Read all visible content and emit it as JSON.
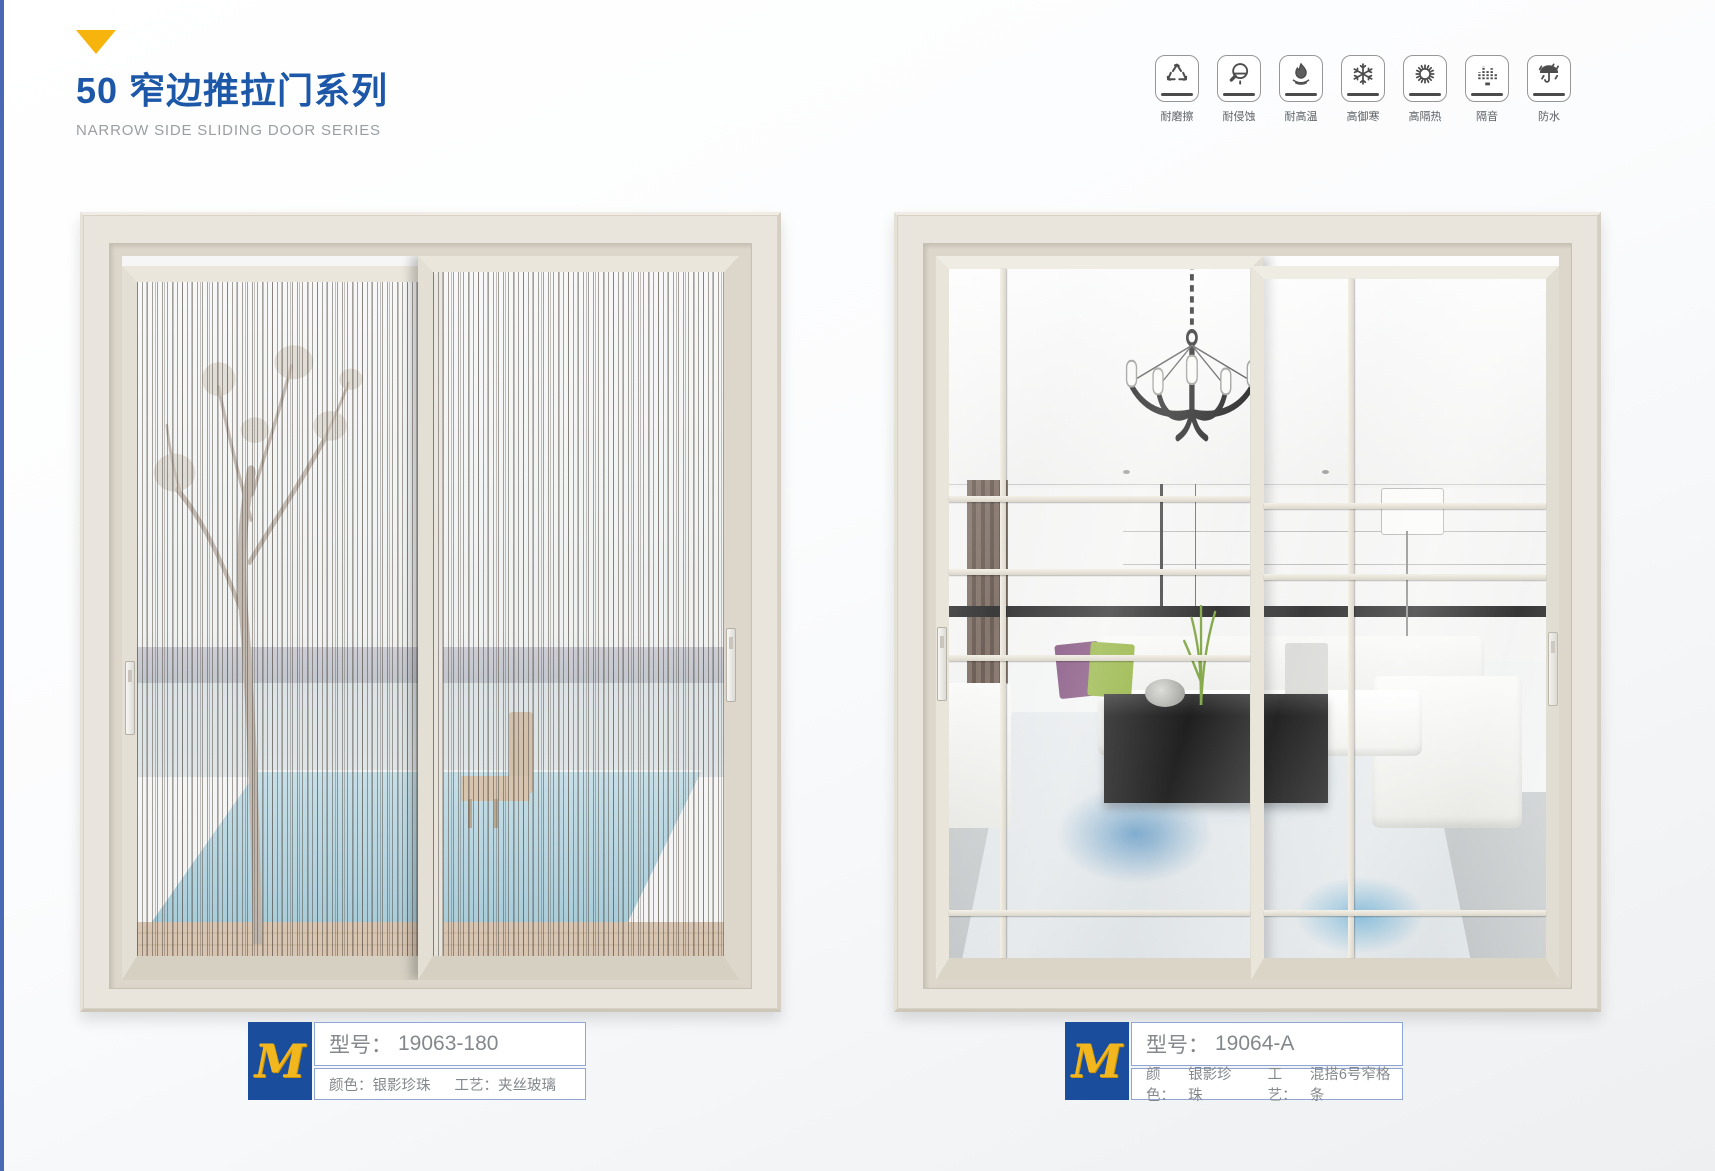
{
  "page": {
    "series_title": "50 窄边推拉门系列",
    "series_subtitle": "NARROW SIDE SLIDING DOOR SERIES"
  },
  "features": [
    {
      "name": "wear-resistant",
      "label": "耐磨擦"
    },
    {
      "name": "corrosion-resistant",
      "label": "耐侵蚀"
    },
    {
      "name": "heat-resistant",
      "label": "耐高温"
    },
    {
      "name": "cold-proof",
      "label": "高御寒"
    },
    {
      "name": "heat-insulation",
      "label": "高隔热"
    },
    {
      "name": "soundproof",
      "label": "隔音"
    },
    {
      "name": "waterproof",
      "label": "防水"
    }
  ],
  "products": [
    {
      "logo": "M",
      "model_label": "型号：",
      "model_value": "19063-180",
      "color_label": "颜色：",
      "color_value": "银影珍珠",
      "craft_label": "工艺：",
      "craft_value": "夹丝玻璃"
    },
    {
      "logo": "M",
      "model_label": "型号：",
      "model_value": "19064-A",
      "color_label": "颜色：",
      "color_value": "银影珍珠",
      "craft_label": "工艺：",
      "craft_value": "混搭6号窄格条"
    }
  ],
  "colors": {
    "accent_blue": "#1d57a8",
    "accent_gold": "#f6b40d",
    "plate_blue": "#1a4e9c",
    "plate_border": "#8fa6d4",
    "left_edge_line": "#4a69b5"
  }
}
